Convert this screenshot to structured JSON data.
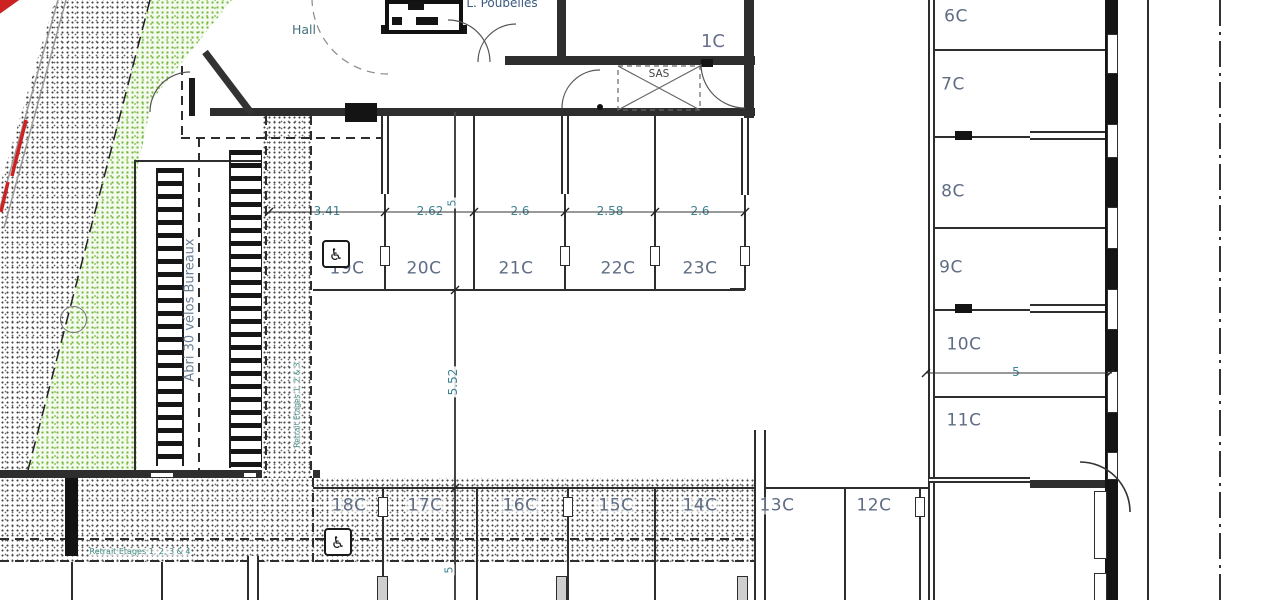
{
  "texts": {
    "hall": "Hall",
    "poubelles": "L. Poubelles",
    "c1": "1C",
    "sas": "SAS",
    "abri": "Abri 30 vélos Bureaux",
    "retrait_v": "Retrait Etages 1, 2 & 3",
    "retrait_h": "Retrait Etages 1, 2, 3 & 4",
    "wheelchair_icon": "♿"
  },
  "dims": {
    "top": [
      "3.41",
      "2.62",
      "2.6",
      "2.58",
      "2.6"
    ],
    "v_top": "5",
    "aisle": "5.52",
    "v_bottom": "5",
    "right": "5"
  },
  "stalls": {
    "top": [
      "19C",
      "20C",
      "21C",
      "22C",
      "23C"
    ],
    "bottom": [
      "18C",
      "17C",
      "16C",
      "15C",
      "14C",
      "13C",
      "12C"
    ],
    "right": [
      "6C",
      "7C",
      "8C",
      "9C",
      "10C",
      "11C"
    ]
  },
  "colors": {
    "wall": "#2e2e2e",
    "dim_text": "#3e8391",
    "stall_text": "#5f6d84",
    "retrait_text": "#3e8a80",
    "vegetation": "#6fb63c",
    "red_mark": "#cc2222"
  }
}
